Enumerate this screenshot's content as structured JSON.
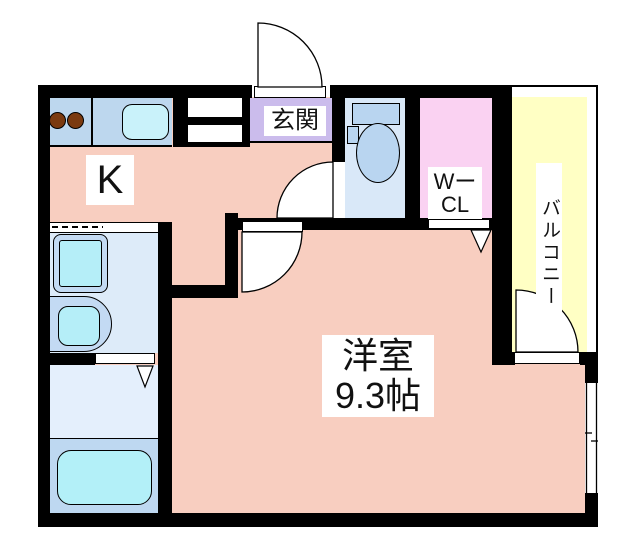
{
  "plan": {
    "kitchen": {
      "label": "K"
    },
    "entrance": {
      "label": "玄関"
    },
    "walk_in_closet": {
      "line1": "Wー",
      "line2": "CL"
    },
    "balcony": {
      "label": "バルコニー"
    },
    "main_room": {
      "line1": "洋室",
      "line2": "9.3帖"
    }
  },
  "colors": {
    "floor_pink": "#f8cec0",
    "counter_blue": "#bdd7ee",
    "sink_cyan": "#c9f2fa",
    "burner_brown": "#7b3a10",
    "entrance_purple": "#cbbcec",
    "toilet_room_blue": "#d9e8f8",
    "fixture_blue": "#b9d5f0",
    "closet_pink": "#fad2f2",
    "balcony_yellow": "#ffffc4",
    "washroom_blue": "#ddebf9",
    "bath_floor_blue": "#e4effc",
    "bath_platform_blue": "#bed8f1",
    "bathtub_cyan": "#b3f0f8",
    "wall_black": "#000000"
  }
}
